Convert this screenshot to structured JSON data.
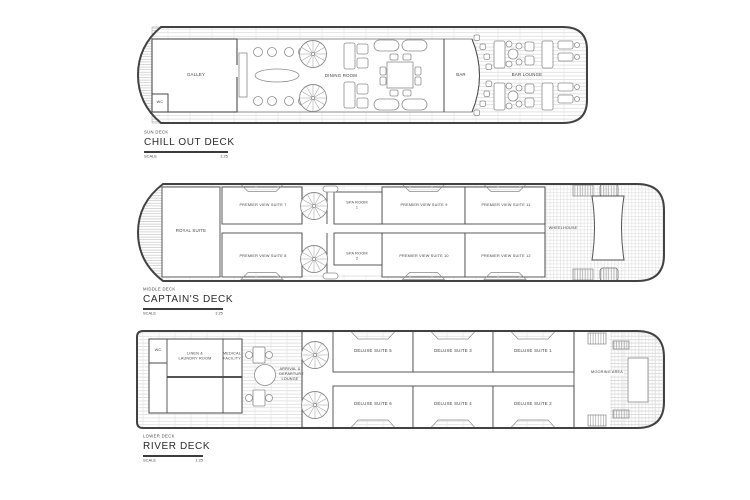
{
  "colors": {
    "paper": "#ffffff",
    "ink": "#3f3f3f",
    "hatch": "#d8d8d8"
  },
  "decks": [
    {
      "code": "SUN DECK",
      "name": "CHILL OUT DECK",
      "scale_label": "SCALE",
      "scale_value": "1:25",
      "rooms": {
        "galley": "GALLEY",
        "wc": "WC",
        "dining_room": "DINING ROOM",
        "bar": "BAR",
        "bar_lounge": "BAR LOUNGE"
      }
    },
    {
      "code": "MIDDLE DECK",
      "name": "CAPTAIN'S DECK",
      "scale_label": "SCALE",
      "scale_value": "1:25",
      "rooms": {
        "royal_suite": "ROYAL SUITE",
        "premier_7": "PREMIER VIEW SUITE 7",
        "premier_8": "PREMIER VIEW SUITE 8",
        "spa_1": "SPA ROOM 1",
        "spa_2": "SPA ROOM 2",
        "premier_9": "PREMIER VIEW SUITE 9",
        "premier_10": "PREMIER VIEW SUITE 10",
        "premier_11": "PREMIER VIEW SUITE 11",
        "premier_12": "PREMIER VIEW SUITE 12",
        "wheelhouse": "WHEELHOUSE"
      }
    },
    {
      "code": "LOWER DECK",
      "name": "RIVER DECK",
      "scale_label": "SCALE",
      "scale_value": "1:25",
      "rooms": {
        "wc": "WC",
        "linen_laundry": "LINEN & LAUNDRY ROOM",
        "medical": "MEDICAL FACILITY",
        "arrival_lounge": "ARRIVAL & DEPARTURE LOUNGE",
        "deluxe_5": "DELUXE SUITE 5",
        "deluxe_3": "DELUXE SUITE 3",
        "deluxe_1": "DELUXE SUITE 1",
        "deluxe_6": "DELUXE SUITE 6",
        "deluxe_4": "DELUXE SUITE 4",
        "deluxe_2": "DELUXE SUITE 2",
        "mooring": "MOORING AREA"
      }
    }
  ]
}
